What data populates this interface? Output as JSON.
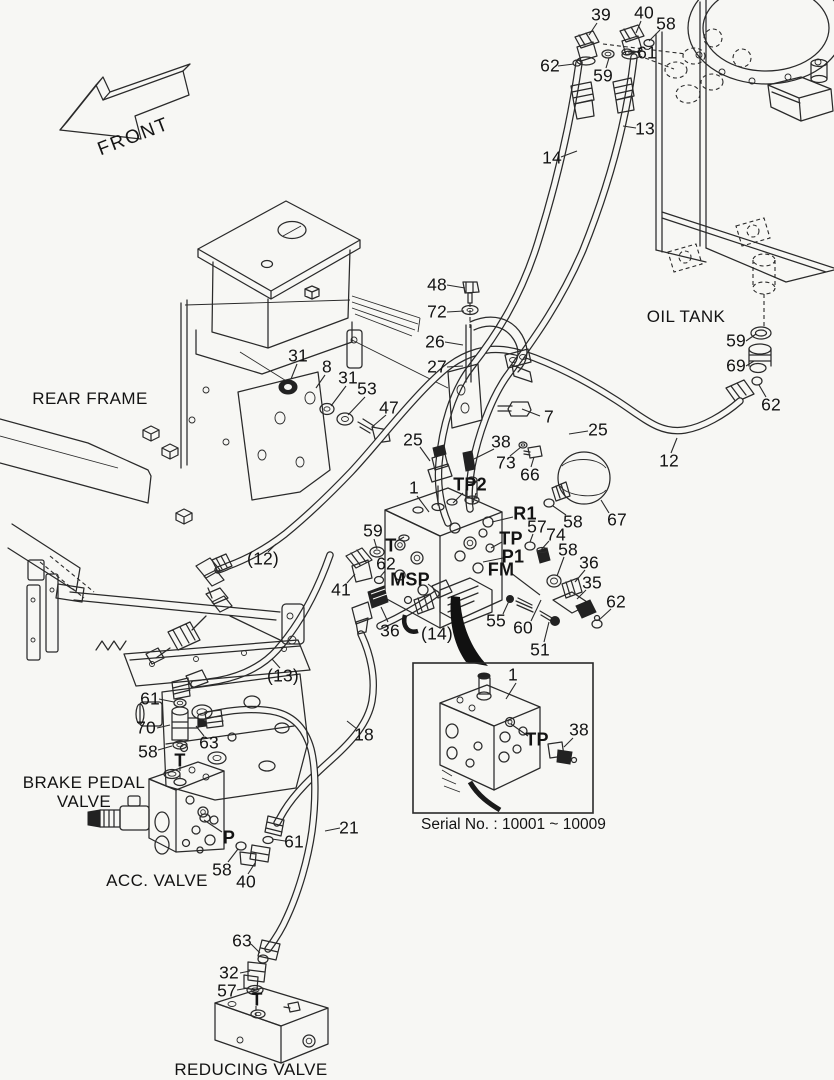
{
  "colors": {
    "background": "#f7f7f4",
    "line": "#2a2a2a",
    "label": "#131313"
  },
  "front_arrow": {
    "label": "FRONT"
  },
  "inset": {
    "serial_text": "Serial No. : 10001 ~ 10009",
    "box": {
      "x": 413,
      "y": 663,
      "w": 180,
      "h": 150
    }
  },
  "section_labels": [
    {
      "id": "rear-frame",
      "text": "REAR FRAME",
      "x": 90,
      "y": 399
    },
    {
      "id": "oil-tank",
      "text": "OIL TANK",
      "x": 686,
      "y": 317
    },
    {
      "id": "brake-pedal-valve-line1",
      "text": "BRAKE PEDAL",
      "x": 84,
      "y": 783
    },
    {
      "id": "brake-pedal-valve-line2",
      "text": "VALVE",
      "x": 84,
      "y": 802
    },
    {
      "id": "acc-valve",
      "text": "ACC. VALVE",
      "x": 157,
      "y": 881
    },
    {
      "id": "reducing-valve",
      "text": "REDUCING VALVE",
      "x": 251,
      "y": 1070
    }
  ],
  "callouts": [
    {
      "t": "39",
      "x": 601,
      "y": 15
    },
    {
      "t": "40",
      "x": 644,
      "y": 13
    },
    {
      "t": "58",
      "x": 666,
      "y": 24
    },
    {
      "t": "62",
      "x": 550,
      "y": 66
    },
    {
      "t": "59",
      "x": 603,
      "y": 76
    },
    {
      "t": "61",
      "x": 647,
      "y": 53
    },
    {
      "t": "13",
      "x": 645,
      "y": 129
    },
    {
      "t": "14",
      "x": 552,
      "y": 158
    },
    {
      "t": "48",
      "x": 437,
      "y": 285
    },
    {
      "t": "72",
      "x": 437,
      "y": 312
    },
    {
      "t": "26",
      "x": 435,
      "y": 342
    },
    {
      "t": "27",
      "x": 437,
      "y": 367
    },
    {
      "t": "7",
      "x": 549,
      "y": 417
    },
    {
      "t": "25",
      "x": 598,
      "y": 430
    },
    {
      "t": "25",
      "x": 413,
      "y": 440
    },
    {
      "t": "38",
      "x": 501,
      "y": 442
    },
    {
      "t": "73",
      "x": 506,
      "y": 463
    },
    {
      "t": "66",
      "x": 530,
      "y": 475
    },
    {
      "t": "31",
      "x": 298,
      "y": 356
    },
    {
      "t": "8",
      "x": 327,
      "y": 367
    },
    {
      "t": "31",
      "x": 348,
      "y": 378
    },
    {
      "t": "53",
      "x": 367,
      "y": 389
    },
    {
      "t": "47",
      "x": 389,
      "y": 408
    },
    {
      "t": "59",
      "x": 736,
      "y": 341
    },
    {
      "t": "69",
      "x": 736,
      "y": 366
    },
    {
      "t": "62",
      "x": 771,
      "y": 405
    },
    {
      "t": "12",
      "x": 669,
      "y": 461
    },
    {
      "t": "1",
      "x": 414,
      "y": 488
    },
    {
      "t": "TP2",
      "x": 470,
      "y": 485,
      "b": true
    },
    {
      "t": "R1",
      "x": 525,
      "y": 514,
      "b": true
    },
    {
      "t": "58",
      "x": 573,
      "y": 522
    },
    {
      "t": "67",
      "x": 617,
      "y": 520
    },
    {
      "t": "57",
      "x": 537,
      "y": 527
    },
    {
      "t": "TP",
      "x": 511,
      "y": 539,
      "b": true
    },
    {
      "t": "74",
      "x": 556,
      "y": 535
    },
    {
      "t": "P1",
      "x": 513,
      "y": 557,
      "b": true
    },
    {
      "t": "58",
      "x": 568,
      "y": 550
    },
    {
      "t": "36",
      "x": 589,
      "y": 563
    },
    {
      "t": "FM",
      "x": 501,
      "y": 570,
      "b": true
    },
    {
      "t": "35",
      "x": 592,
      "y": 583
    },
    {
      "t": "62",
      "x": 616,
      "y": 602
    },
    {
      "t": "59",
      "x": 373,
      "y": 531
    },
    {
      "t": "T",
      "x": 391,
      "y": 546,
      "b": true
    },
    {
      "t": "62",
      "x": 386,
      "y": 564
    },
    {
      "t": "MSP",
      "x": 410,
      "y": 580,
      "b": true
    },
    {
      "t": "41",
      "x": 341,
      "y": 590
    },
    {
      "t": "36",
      "x": 390,
      "y": 631
    },
    {
      "t": "(14)",
      "x": 437,
      "y": 634
    },
    {
      "t": "55",
      "x": 496,
      "y": 621
    },
    {
      "t": "60",
      "x": 523,
      "y": 628
    },
    {
      "t": "51",
      "x": 540,
      "y": 650
    },
    {
      "t": "(12)",
      "x": 263,
      "y": 559
    },
    {
      "t": "(13)",
      "x": 283,
      "y": 676
    },
    {
      "t": "61",
      "x": 150,
      "y": 699
    },
    {
      "t": "70",
      "x": 146,
      "y": 728
    },
    {
      "t": "63",
      "x": 209,
      "y": 743
    },
    {
      "t": "58",
      "x": 148,
      "y": 752
    },
    {
      "t": "T",
      "x": 180,
      "y": 761,
      "b": true
    },
    {
      "t": "18",
      "x": 364,
      "y": 735
    },
    {
      "t": "21",
      "x": 349,
      "y": 828
    },
    {
      "t": "61",
      "x": 294,
      "y": 842
    },
    {
      "t": "P",
      "x": 229,
      "y": 838,
      "b": true
    },
    {
      "t": "58",
      "x": 222,
      "y": 870
    },
    {
      "t": "40",
      "x": 246,
      "y": 882
    },
    {
      "t": "63",
      "x": 242,
      "y": 941
    },
    {
      "t": "32",
      "x": 229,
      "y": 973
    },
    {
      "t": "57",
      "x": 227,
      "y": 991
    },
    {
      "t": "T",
      "x": 257,
      "y": 1000,
      "b": true
    },
    {
      "t": "1",
      "x": 513,
      "y": 675
    },
    {
      "t": "TP",
      "x": 537,
      "y": 740,
      "b": true
    },
    {
      "t": "38",
      "x": 579,
      "y": 730
    }
  ],
  "leaders": [
    [
      597,
      23,
      589,
      35
    ],
    [
      641,
      21,
      636,
      33
    ],
    [
      660,
      30,
      649,
      41
    ],
    [
      558,
      66,
      574,
      64
    ],
    [
      606,
      68,
      609,
      58
    ],
    [
      638,
      52,
      628,
      52
    ],
    [
      636,
      128,
      623,
      126
    ],
    [
      561,
      157,
      577,
      151
    ],
    [
      447,
      285,
      465,
      288
    ],
    [
      447,
      312,
      464,
      311
    ],
    [
      445,
      342,
      463,
      345
    ],
    [
      447,
      367,
      463,
      366
    ],
    [
      540,
      416,
      522,
      409
    ],
    [
      588,
      431,
      569,
      434
    ],
    [
      420,
      447,
      430,
      461
    ],
    [
      494,
      449,
      474,
      459
    ],
    [
      510,
      456,
      521,
      447
    ],
    [
      531,
      467,
      534,
      457
    ],
    [
      297,
      364,
      291,
      379
    ],
    [
      325,
      375,
      316,
      388
    ],
    [
      346,
      386,
      331,
      406
    ],
    [
      365,
      397,
      348,
      415
    ],
    [
      386,
      415,
      372,
      427
    ],
    [
      746,
      341,
      756,
      334
    ],
    [
      746,
      366,
      754,
      361
    ],
    [
      766,
      397,
      759,
      385
    ],
    [
      671,
      453,
      677,
      438
    ],
    [
      417,
      496,
      429,
      512
    ],
    [
      463,
      493,
      453,
      503
    ],
    [
      476,
      493,
      473,
      503
    ],
    [
      513,
      517,
      492,
      522
    ],
    [
      566,
      515,
      553,
      506
    ],
    [
      609,
      513,
      601,
      500
    ],
    [
      533,
      534,
      530,
      542
    ],
    [
      502,
      542,
      491,
      548
    ],
    [
      549,
      541,
      540,
      551
    ],
    [
      503,
      558,
      483,
      562
    ],
    [
      564,
      557,
      557,
      576
    ],
    [
      585,
      570,
      575,
      582
    ],
    [
      511,
      573,
      540,
      595
    ],
    [
      586,
      590,
      577,
      599
    ],
    [
      611,
      609,
      599,
      620
    ],
    [
      374,
      539,
      377,
      549
    ],
    [
      397,
      541,
      404,
      537
    ],
    [
      385,
      571,
      380,
      577
    ],
    [
      428,
      584,
      438,
      592
    ],
    [
      347,
      583,
      355,
      574
    ],
    [
      388,
      622,
      381,
      607
    ],
    [
      503,
      614,
      509,
      601
    ],
    [
      531,
      621,
      541,
      600
    ],
    [
      544,
      642,
      549,
      622
    ],
    [
      268,
      552,
      276,
      544
    ],
    [
      280,
      668,
      272,
      659
    ],
    [
      159,
      699,
      174,
      702
    ],
    [
      157,
      728,
      170,
      725
    ],
    [
      204,
      736,
      196,
      726
    ],
    [
      158,
      750,
      172,
      746
    ],
    [
      357,
      729,
      347,
      721
    ],
    [
      340,
      828,
      325,
      831
    ],
    [
      285,
      841,
      272,
      839
    ],
    [
      222,
      832,
      204,
      820
    ],
    [
      228,
      862,
      238,
      849
    ],
    [
      248,
      874,
      255,
      863
    ],
    [
      251,
      944,
      260,
      953
    ],
    [
      240,
      973,
      250,
      971
    ],
    [
      237,
      990,
      248,
      988
    ],
    [
      516,
      683,
      506,
      699
    ],
    [
      528,
      736,
      511,
      724
    ],
    [
      573,
      738,
      564,
      747
    ]
  ]
}
